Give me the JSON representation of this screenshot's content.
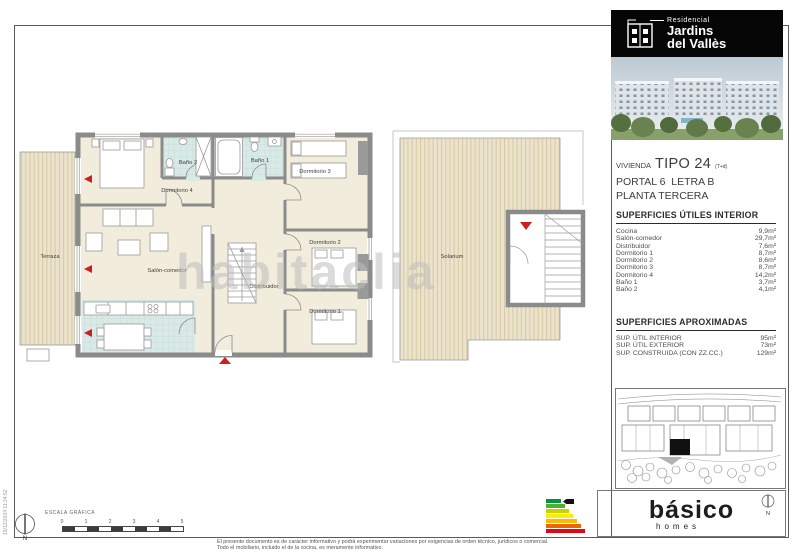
{
  "logo": {
    "residencial": "Residencial",
    "line1": "Jardins",
    "line2": "del Vallès"
  },
  "unit": {
    "vivienda_label": "VIVIENDA",
    "tipo": "TIPO 24",
    "tipo_note": "(T+d)",
    "portal": "PORTAL 6  LETRA B",
    "planta": "PLANTA TERCERA"
  },
  "interior": {
    "title": "SUPERFICIES ÚTILES INTERIOR",
    "rows": [
      {
        "name": "Cocina",
        "value": "9,9m²"
      },
      {
        "name": "Salón-comedor",
        "value": "29,7m²"
      },
      {
        "name": "Distribuidor",
        "value": "7,6m²"
      },
      {
        "name": "Dormitorio 1",
        "value": "8,7m²"
      },
      {
        "name": "Dormitorio 2",
        "value": "8,6m²"
      },
      {
        "name": "Dormitorio 3",
        "value": "8,7m²"
      },
      {
        "name": "Dormitorio 4",
        "value": "14,2m²"
      },
      {
        "name": "Baño 1",
        "value": "3,7m²"
      },
      {
        "name": "Baño 2",
        "value": "4,1m²"
      }
    ]
  },
  "aprox": {
    "title": "SUPERFICIES APROXIMADAS",
    "rows": [
      {
        "name": "SUP. ÚTIL INTERIOR",
        "value": "95m²"
      },
      {
        "name": "SUP. ÚTIL EXTERIOR",
        "value": "73m²"
      },
      {
        "name": "SUP. CONSTRUIDA (CON ZZ.CC.)",
        "value": "129m²"
      }
    ]
  },
  "plan": {
    "terraza": "Terraza",
    "dormitorio4": "Dormitorio 4",
    "bano2": "Baño 2",
    "bano1": "Baño 1",
    "dormitorio3": "Dormitorio 3",
    "salon": "Salón-comedor",
    "distribuidor": "Distribuidor",
    "dormitorio2": "Dormitorio 2",
    "dormitorio1": "Dormitorio 1",
    "solarium": "Solarium"
  },
  "watermark": "habitaclia",
  "scale": {
    "label": "ESCALA GRÁFICA",
    "ticks": [
      "0",
      "1",
      "2",
      "3",
      "4",
      "5"
    ]
  },
  "compass_n": "N",
  "brand": {
    "name": "básico",
    "sub": "homes"
  },
  "energy": {
    "colors": [
      "#009640",
      "#52ae32",
      "#c7d301",
      "#ffed00",
      "#fbba00",
      "#ec6608",
      "#e30613"
    ],
    "widths": [
      15,
      19,
      23,
      27,
      31,
      35,
      39
    ],
    "marker_color": "#111111"
  },
  "footer": {
    "line1": "El presente documento es de carácter informativo y podrá experimentar variaciones por exigencias de orden técnico, jurídicos o comercial.",
    "line2": "Todo el mobiliario, incluido el de la cocina, es meramente informativo."
  },
  "timestamp": "19/12/2024 11:24:52"
}
